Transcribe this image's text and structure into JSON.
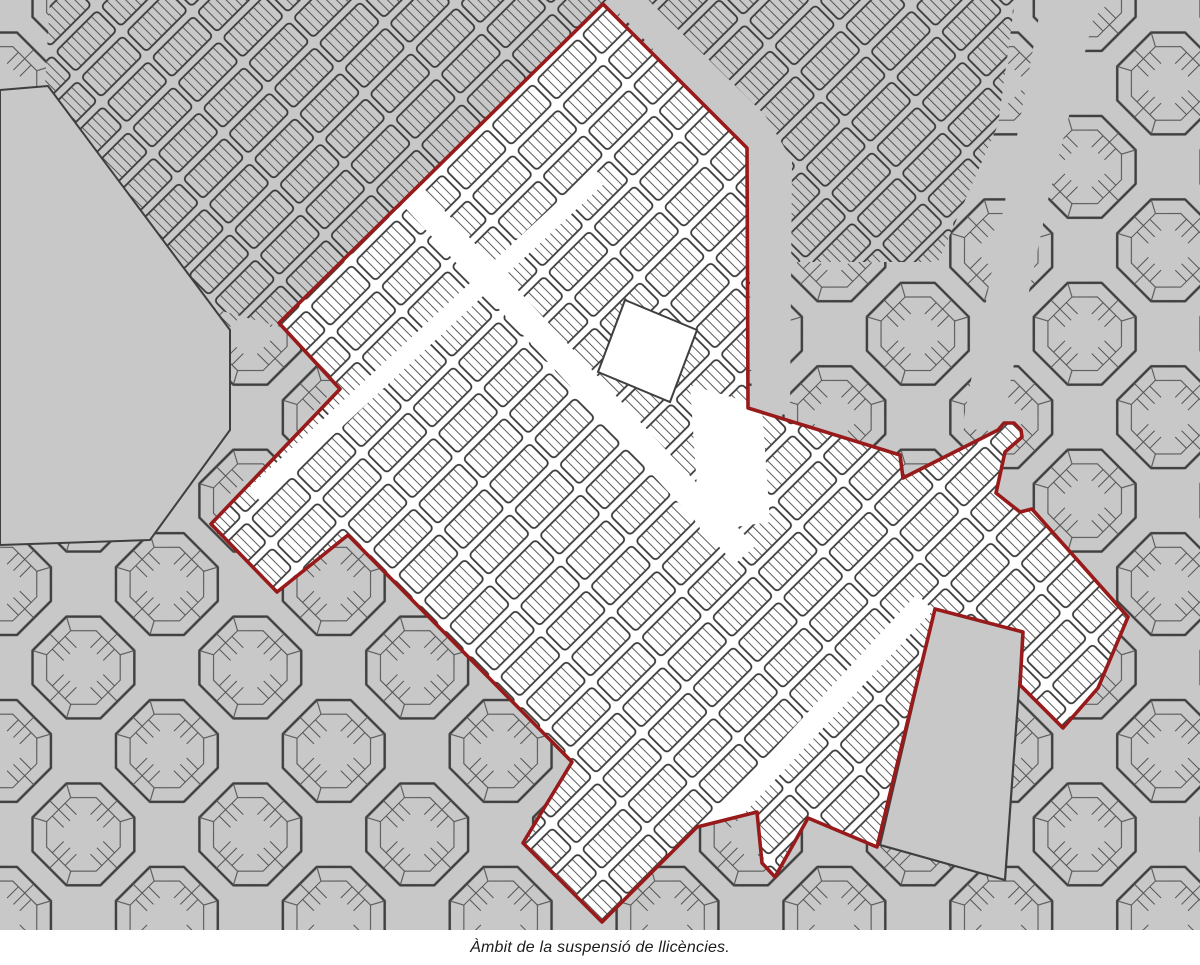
{
  "figure": {
    "caption": "Àmbit de la suspensió de llicències."
  },
  "map": {
    "colors": {
      "background": "#c8c8c8",
      "street": "#ffffff",
      "block_outline": "#3f3f3f",
      "parcel_line": "#4f4f4f",
      "suspension_fill": "#ffffff",
      "boundary_red": "#991a1a"
    },
    "suspension_area": {
      "label": "Àmbit de la suspensió de llicències",
      "boundary_points": "603,4 747,148 748,408 900,455 903,478 998,430 1004,423 1014,423 1021,430 1022,437 1005,452 996,493 1020,512 1032,509 1128,617 1098,688 1063,728 1020,685 1023,632 935,609 877,847 808,818 775,877 762,863 757,812 697,827 602,922 523,843 572,762 348,535 277,592 211,524 340,389 279,323"
    },
    "features": {
      "solid_block_points": "935,609 1023,632 1005,880 880,845",
      "open_area_nw_points": "0,90 48,86 230,330 230,430 150,540 0,545",
      "dense_zone_n_points": "50,0 612,0 292,330 200,305 45,85",
      "dense_zone_ne_points": "610,0 1015,0 998,125 938,262 752,262 748,150",
      "avenue_ne_points": "1042,0 1098,0 1048,200 1000,432 962,428 1006,196",
      "avenue_east_edge_points": "607,0 648,0 765,115 792,160 790,415 752,412 748,150",
      "inner_avenue_1_points": "380,141 755,546 735,564 360,159",
      "inner_avenue_2_points": "690,385 762,406 770,522 700,532",
      "inner_avenue_3_points": "692,838 708,852 933,610 917,594",
      "inner_avenue_4_points": "249,488 261,502 606,182 594,168",
      "inner_plain_block_points": "625,300 697,330 670,402 598,372"
    }
  }
}
